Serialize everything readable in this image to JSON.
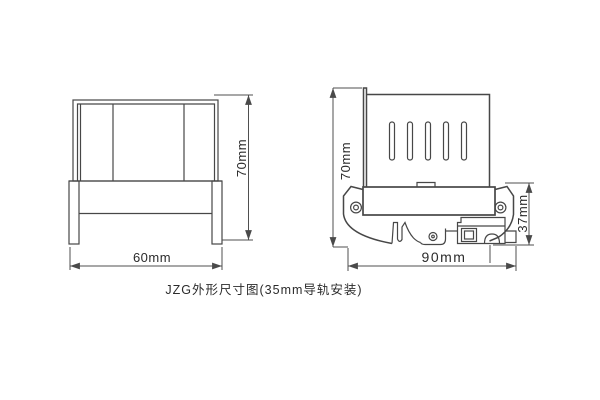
{
  "caption": "JZG外形尺寸图(35mm导轨安装)",
  "colors": {
    "line": "#474747",
    "dim": "#4f4f4f",
    "text": "#2b2b2b",
    "background": "#ffffff"
  },
  "front_view": {
    "width_dim": "60mm",
    "height_dim": "70mm"
  },
  "side_view": {
    "height_dim": "70mm",
    "width_dim": "90mm",
    "base_height_dim": "37mm"
  }
}
